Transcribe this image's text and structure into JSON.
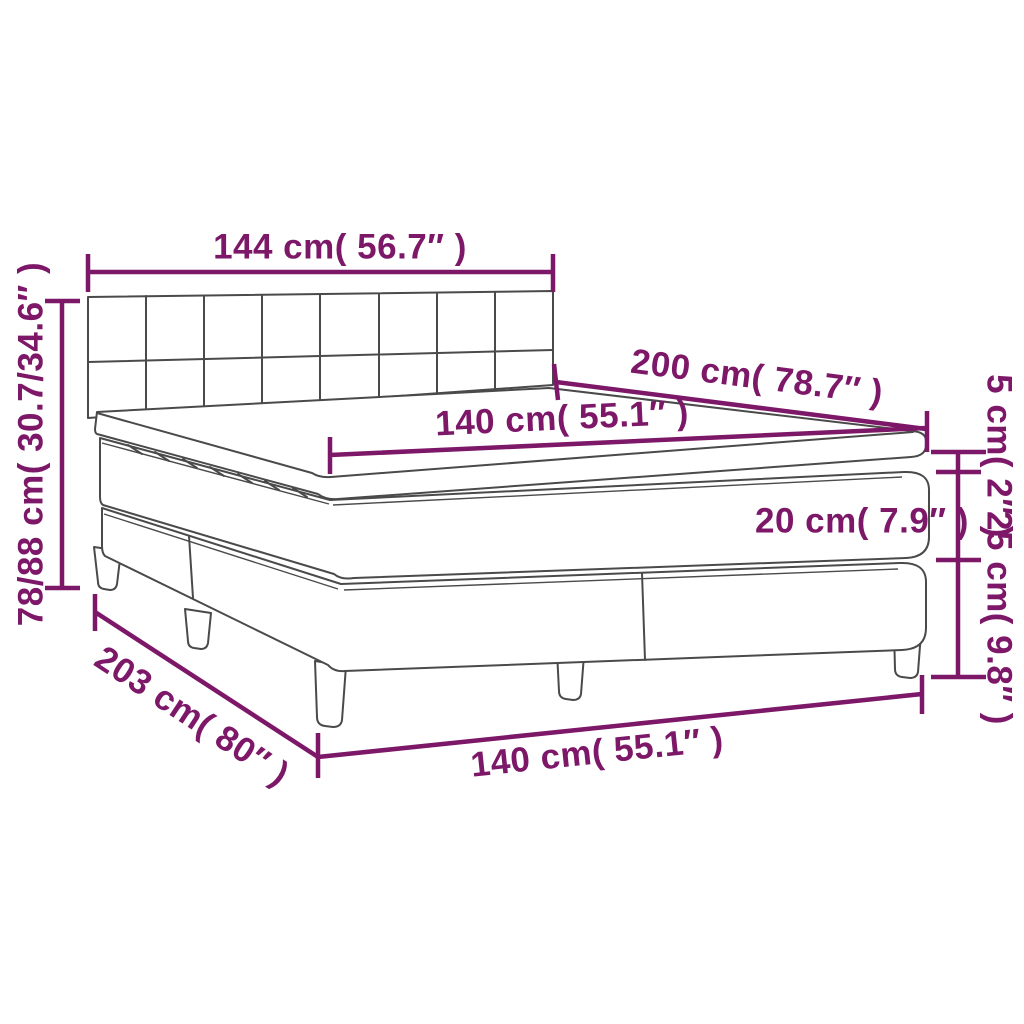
{
  "diagram": {
    "kind": "product-dimension-diagram",
    "subject": "box spring bed with mattress and topper (line drawing)",
    "colors": {
      "dimension_color": "#7d1768",
      "outline_color": "#4a4a4a",
      "background": "#ffffff"
    },
    "dimensions": {
      "headboard_width": "144 cm( 56.7″ )",
      "overall_height": "78/88 cm( 30.7/34.6″ )",
      "bed_length_top": "200 cm( 78.7″ )",
      "mattress_width_top": "140 cm( 55.1″ )",
      "topper_thickness": "5 cm( 2″ )",
      "mattress_thickness": "20 cm( 7.9″ )",
      "base_height": "25 cm( 9.8″ )",
      "base_length": "203 cm( 80″ )",
      "mattress_width_bottom": "140 cm( 55.1″ )"
    }
  }
}
